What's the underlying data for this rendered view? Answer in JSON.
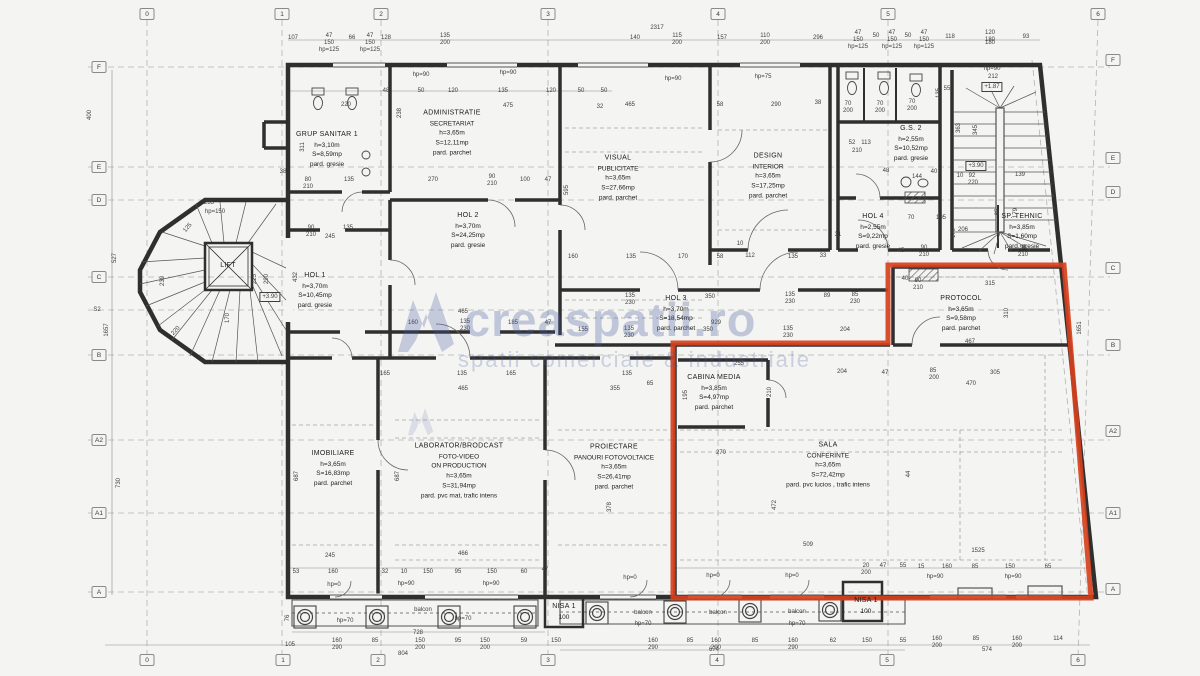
{
  "watermark": {
    "brand": "creaspatii.ro",
    "tagline": "spatii comerciale & industriale"
  },
  "colors": {
    "highlight": "#d5411d",
    "wall": "#2f2f2f",
    "dim_text": "#3f3f3f",
    "grid": "#b3b3b3",
    "watermark": "#485ca2"
  },
  "grid_bubbles": {
    "top": [
      {
        "label": "0",
        "x": 147
      },
      {
        "label": "1",
        "x": 282
      },
      {
        "label": "2",
        "x": 381
      },
      {
        "label": "3",
        "x": 548
      },
      {
        "label": "4",
        "x": 718
      },
      {
        "label": "5",
        "x": 888
      },
      {
        "label": "6",
        "x": 1098
      }
    ],
    "bottom": [
      {
        "label": "0",
        "x": 147
      },
      {
        "label": "1",
        "x": 283
      },
      {
        "label": "2",
        "x": 378
      },
      {
        "label": "3",
        "x": 548
      },
      {
        "label": "4",
        "x": 717
      },
      {
        "label": "5",
        "x": 887
      },
      {
        "label": "6",
        "x": 1078
      }
    ],
    "left": [
      {
        "label": "F",
        "y": 67
      },
      {
        "label": "E",
        "y": 167
      },
      {
        "label": "D",
        "y": 200
      },
      {
        "label": "C",
        "y": 277
      },
      {
        "label": "B",
        "y": 355
      },
      {
        "label": "A2",
        "y": 440
      },
      {
        "label": "A1",
        "y": 513
      },
      {
        "label": "A",
        "y": 592
      }
    ],
    "right": [
      {
        "label": "F",
        "y": 60
      },
      {
        "label": "E",
        "y": 158
      },
      {
        "label": "D",
        "y": 192
      },
      {
        "label": "C",
        "y": 268
      },
      {
        "label": "B",
        "y": 345
      },
      {
        "label": "A2",
        "y": 431
      },
      {
        "label": "A1",
        "y": 513
      },
      {
        "label": "A",
        "y": 589
      }
    ]
  },
  "rooms": [
    {
      "id": "grup-sanitar-1",
      "x": 327,
      "y": 150,
      "lines": [
        "GRUP SANITAR 1",
        "h=3,10m",
        "S=8,59mp",
        "pard. gresie"
      ]
    },
    {
      "id": "administratie-secretariat",
      "x": 452,
      "y": 133,
      "lines": [
        "ADMINISTRATIE",
        "SECRETARIAT",
        "h=3,65m",
        "S=12,11mp",
        "pard. parchet"
      ]
    },
    {
      "id": "hol-2",
      "x": 468,
      "y": 231,
      "lines": [
        "HOL 2",
        "h=3,70m",
        "S=24,25mp",
        "pard. gresie"
      ]
    },
    {
      "id": "hol-1",
      "x": 315,
      "y": 291,
      "lines": [
        "HOL 1",
        "h=3,70m",
        "S=10,45mp",
        "pard. gresie"
      ]
    },
    {
      "id": "visual-publicitate",
      "x": 618,
      "y": 178,
      "lines": [
        "VISUAL",
        "PUBLICITATE",
        "h=3,65m",
        "S=27,66mp",
        "pard. parchet"
      ]
    },
    {
      "id": "design-interior",
      "x": 768,
      "y": 176,
      "lines": [
        "DESIGN",
        "INTERIOR",
        "h=3,65m",
        "S=17,25mp",
        "pard. parchet"
      ]
    },
    {
      "id": "gs-2",
      "x": 911,
      "y": 144,
      "lines": [
        "G.S. 2",
        "h=2,55m",
        "S=10,52mp",
        "pard. gresie"
      ]
    },
    {
      "id": "hol-4",
      "x": 873,
      "y": 232,
      "lines": [
        "HOL 4",
        "h=2,55m",
        "S=9,22mp",
        "pard. gresie"
      ]
    },
    {
      "id": "sp-tehnic",
      "x": 1022,
      "y": 232,
      "lines": [
        "SP. TEHNIC",
        "h=3,85m",
        "S=1,60mp",
        "pard. gresie"
      ]
    },
    {
      "id": "protocol",
      "x": 961,
      "y": 314,
      "lines": [
        "PROTOCOL",
        "h=3,65m",
        "S=9,58mp",
        "pard. parchet"
      ]
    },
    {
      "id": "hol-3",
      "x": 676,
      "y": 314,
      "lines": [
        "HOL 3",
        "h=3,70m",
        "S=18,54mp",
        "pard. parchet"
      ]
    },
    {
      "id": "cabina-media",
      "x": 714,
      "y": 393,
      "lines": [
        "CABINA MEDIA",
        "h=3,85m",
        "S=4,97mp",
        "pard. parchet"
      ]
    },
    {
      "id": "sala-conferinte",
      "x": 828,
      "y": 465,
      "lines": [
        "SALA",
        "CONFERINTE",
        "h=3,65m",
        "S=72,42mp",
        "pard. pvc lucios , trafic intens"
      ]
    },
    {
      "id": "imobiliare",
      "x": 333,
      "y": 469,
      "lines": [
        "IMOBILIARE",
        "h=3,65m",
        "S=16,83mp",
        "pard. parchet"
      ]
    },
    {
      "id": "laborator-brodcast",
      "x": 459,
      "y": 471,
      "lines": [
        "LABORATOR/BRODCAST",
        "FOTO-VIDEO",
        "ON PRODUCTION",
        "h=3,65m",
        "S=31,94mp",
        "pard. pvc mat, trafic intens"
      ]
    },
    {
      "id": "proiectare-fotovoltaice",
      "x": 614,
      "y": 467,
      "lines": [
        "PROIECTARE",
        "PANOURI FOTOVOLTAICE",
        "h=3,65m",
        "S=26,41mp",
        "pard. parchet"
      ]
    },
    {
      "id": "lift",
      "x": 228,
      "y": 266,
      "lines": [
        "LIFT"
      ]
    },
    {
      "id": "nisa-1-left",
      "x": 564,
      "y": 612,
      "lines": [
        "NISA 1",
        "100"
      ]
    },
    {
      "id": "nisa-1-right",
      "x": 866,
      "y": 606,
      "lines": [
        "NISA 1",
        "100"
      ]
    }
  ],
  "labels": [
    [
      657,
      28,
      "2317"
    ],
    [
      293,
      38,
      "107"
    ],
    [
      329,
      36,
      "47"
    ],
    [
      329,
      43,
      "150"
    ],
    [
      352,
      38,
      "66"
    ],
    [
      370,
      36,
      "47"
    ],
    [
      370,
      43,
      "150"
    ],
    [
      386,
      38,
      "128"
    ],
    [
      445,
      36,
      "135"
    ],
    [
      445,
      43,
      "200"
    ],
    [
      635,
      38,
      "140"
    ],
    [
      677,
      36,
      "115"
    ],
    [
      677,
      43,
      "200"
    ],
    [
      722,
      38,
      "157"
    ],
    [
      765,
      36,
      "110"
    ],
    [
      765,
      43,
      "200"
    ],
    [
      818,
      38,
      "296"
    ],
    [
      858,
      33,
      "47"
    ],
    [
      858,
      40,
      "150"
    ],
    [
      876,
      36,
      "50"
    ],
    [
      892,
      33,
      "47"
    ],
    [
      892,
      40,
      "150"
    ],
    [
      908,
      36,
      "50"
    ],
    [
      924,
      33,
      "47"
    ],
    [
      924,
      40,
      "150"
    ],
    [
      950,
      37,
      "118"
    ],
    [
      990,
      33,
      "120"
    ],
    [
      990,
      40,
      "180"
    ],
    [
      1026,
      37,
      "93"
    ],
    [
      329,
      50,
      "hp=125"
    ],
    [
      370,
      50,
      "hp=125"
    ],
    [
      858,
      47,
      "hp=125"
    ],
    [
      892,
      47,
      "hp=125"
    ],
    [
      924,
      47,
      "hp=125"
    ],
    [
      421,
      75,
      "hp=90"
    ],
    [
      508,
      73,
      "hp=90"
    ],
    [
      673,
      79,
      "hp=90"
    ],
    [
      763,
      77,
      "hp=75"
    ],
    [
      992,
      69,
      "hp=90"
    ],
    [
      993,
      77,
      "212"
    ],
    [
      992,
      87,
      "+1.87",
      0,
      "b"
    ],
    [
      386,
      91,
      "48"
    ],
    [
      421,
      91,
      "50"
    ],
    [
      453,
      91,
      "120"
    ],
    [
      503,
      91,
      "135"
    ],
    [
      551,
      91,
      "120"
    ],
    [
      581,
      91,
      "50"
    ],
    [
      604,
      91,
      "50"
    ],
    [
      508,
      106,
      "475"
    ],
    [
      600,
      107,
      "32"
    ],
    [
      400,
      113,
      "238",
      -90
    ],
    [
      630,
      105,
      "465"
    ],
    [
      720,
      105,
      "58"
    ],
    [
      776,
      105,
      "290"
    ],
    [
      818,
      103,
      "38"
    ],
    [
      346,
      105,
      "220"
    ],
    [
      303,
      147,
      "311",
      -90
    ],
    [
      283,
      172,
      "38"
    ],
    [
      308,
      180,
      "80"
    ],
    [
      308,
      187,
      "210"
    ],
    [
      349,
      180,
      "135"
    ],
    [
      848,
      104,
      "70"
    ],
    [
      848,
      111,
      "200"
    ],
    [
      880,
      104,
      "70"
    ],
    [
      880,
      111,
      "200"
    ],
    [
      912,
      102,
      "70"
    ],
    [
      912,
      109,
      "200"
    ],
    [
      939,
      93,
      "135",
      -90
    ],
    [
      947,
      89,
      "55"
    ],
    [
      433,
      180,
      "270"
    ],
    [
      492,
      177,
      "90"
    ],
    [
      492,
      184,
      "210"
    ],
    [
      525,
      180,
      "100"
    ],
    [
      548,
      180,
      "47"
    ],
    [
      852,
      143,
      "52"
    ],
    [
      866,
      143,
      "113"
    ],
    [
      857,
      151,
      "210"
    ],
    [
      886,
      171,
      "48"
    ],
    [
      934,
      172,
      "40"
    ],
    [
      917,
      177,
      "144"
    ],
    [
      960,
      176,
      "10"
    ],
    [
      972,
      176,
      "92"
    ],
    [
      973,
      183,
      "220"
    ],
    [
      959,
      128,
      "363",
      -90
    ],
    [
      976,
      130,
      "345",
      -90
    ],
    [
      976,
      166,
      "+3.90",
      0,
      "b"
    ],
    [
      1020,
      175,
      "139"
    ],
    [
      998,
      212,
      "85",
      -90
    ],
    [
      1016,
      213,
      "179",
      -90
    ],
    [
      1023,
      248,
      "90"
    ],
    [
      1023,
      255,
      "210"
    ],
    [
      963,
      230,
      "206"
    ],
    [
      954,
      233,
      "170",
      -90
    ],
    [
      941,
      218,
      "105"
    ],
    [
      911,
      218,
      "70"
    ],
    [
      901,
      251,
      "45"
    ],
    [
      924,
      248,
      "90"
    ],
    [
      924,
      255,
      "210"
    ],
    [
      990,
      43,
      "180"
    ],
    [
      311,
      228,
      "90"
    ],
    [
      311,
      235,
      "210"
    ],
    [
      348,
      228,
      "135"
    ],
    [
      330,
      237,
      "245"
    ],
    [
      463,
      312,
      "465"
    ],
    [
      413,
      323,
      "160"
    ],
    [
      465,
      322,
      "135"
    ],
    [
      465,
      329,
      "230"
    ],
    [
      513,
      323,
      "185"
    ],
    [
      548,
      323,
      "47"
    ],
    [
      583,
      330,
      "155"
    ],
    [
      385,
      374,
      "165"
    ],
    [
      462,
      374,
      "135"
    ],
    [
      511,
      374,
      "165"
    ],
    [
      627,
      374,
      "135"
    ],
    [
      650,
      384,
      "65"
    ],
    [
      463,
      389,
      "465"
    ],
    [
      615,
      389,
      "355"
    ],
    [
      209,
      203,
      "235"
    ],
    [
      215,
      212,
      "hp=150"
    ],
    [
      188,
      228,
      "125",
      -50
    ],
    [
      163,
      281,
      "239",
      -90
    ],
    [
      255,
      279,
      "225",
      -90
    ],
    [
      267,
      279,
      "290",
      -90
    ],
    [
      296,
      277,
      "432",
      -90
    ],
    [
      176,
      331,
      "220",
      -48
    ],
    [
      270,
      297,
      "+3.90",
      0,
      "b"
    ],
    [
      228,
      318,
      "170",
      -90
    ],
    [
      630,
      296,
      "135"
    ],
    [
      630,
      303,
      "230"
    ],
    [
      710,
      297,
      "350"
    ],
    [
      790,
      295,
      "135"
    ],
    [
      790,
      302,
      "230"
    ],
    [
      827,
      296,
      "89"
    ],
    [
      855,
      295,
      "85"
    ],
    [
      855,
      302,
      "230"
    ],
    [
      716,
      323,
      "929"
    ],
    [
      629,
      329,
      "135"
    ],
    [
      629,
      336,
      "230"
    ],
    [
      708,
      330,
      "350"
    ],
    [
      788,
      329,
      "135"
    ],
    [
      788,
      336,
      "230"
    ],
    [
      845,
      330,
      "204"
    ],
    [
      905,
      279,
      "40"
    ],
    [
      918,
      281,
      "90"
    ],
    [
      918,
      288,
      "210"
    ],
    [
      573,
      257,
      "160"
    ],
    [
      631,
      257,
      "135"
    ],
    [
      683,
      257,
      "170"
    ],
    [
      720,
      257,
      "58"
    ],
    [
      750,
      256,
      "112"
    ],
    [
      793,
      257,
      "135"
    ],
    [
      823,
      256,
      "33"
    ],
    [
      838,
      235,
      "31"
    ],
    [
      740,
      244,
      "10"
    ],
    [
      990,
      284,
      "315"
    ],
    [
      1007,
      313,
      "310",
      -90
    ],
    [
      970,
      342,
      "467"
    ],
    [
      933,
      371,
      "85"
    ],
    [
      934,
      378,
      "200"
    ],
    [
      995,
      373,
      "305"
    ],
    [
      971,
      384,
      "470"
    ],
    [
      739,
      364,
      "255"
    ],
    [
      842,
      372,
      "204"
    ],
    [
      885,
      373,
      "47"
    ],
    [
      721,
      453,
      "270"
    ],
    [
      775,
      505,
      "472",
      -90
    ],
    [
      808,
      545,
      "509"
    ],
    [
      686,
      395,
      "195",
      -90
    ],
    [
      770,
      392,
      "210",
      -90
    ],
    [
      909,
      474,
      "44",
      -90
    ],
    [
      1080,
      328,
      "1651",
      -90
    ],
    [
      297,
      476,
      "687",
      -90
    ],
    [
      398,
      476,
      "687",
      -90
    ],
    [
      567,
      190,
      "595",
      -90
    ],
    [
      610,
      507,
      "378",
      -90
    ],
    [
      330,
      556,
      "245"
    ],
    [
      463,
      554,
      "466"
    ],
    [
      296,
      572,
      "53"
    ],
    [
      333,
      572,
      "160"
    ],
    [
      385,
      572,
      "32"
    ],
    [
      404,
      572,
      "10"
    ],
    [
      428,
      572,
      "150"
    ],
    [
      458,
      572,
      "95"
    ],
    [
      492,
      572,
      "150"
    ],
    [
      524,
      572,
      "60"
    ],
    [
      545,
      570,
      "47"
    ],
    [
      866,
      566,
      "20"
    ],
    [
      866,
      573,
      "200"
    ],
    [
      883,
      566,
      "47"
    ],
    [
      903,
      566,
      "55"
    ],
    [
      921,
      567,
      "15"
    ],
    [
      947,
      567,
      "160"
    ],
    [
      975,
      567,
      "85"
    ],
    [
      1010,
      567,
      "150"
    ],
    [
      1048,
      567,
      "65"
    ],
    [
      978,
      551,
      "1525"
    ],
    [
      334,
      585,
      "hp=0"
    ],
    [
      406,
      584,
      "hp=90"
    ],
    [
      491,
      584,
      "hp=90"
    ],
    [
      630,
      578,
      "hp=0"
    ],
    [
      713,
      576,
      "hp=0"
    ],
    [
      792,
      576,
      "hp=0"
    ],
    [
      935,
      577,
      "hp=90"
    ],
    [
      1013,
      577,
      "hp=90"
    ],
    [
      423,
      610,
      "balcon"
    ],
    [
      643,
      613,
      "balcon"
    ],
    [
      718,
      613,
      "balcon"
    ],
    [
      797,
      612,
      "balcon"
    ],
    [
      345,
      621,
      "hp=70"
    ],
    [
      463,
      619,
      "hp=70"
    ],
    [
      643,
      624,
      "hp=70"
    ],
    [
      797,
      624,
      "hp=70"
    ],
    [
      290,
      645,
      "105"
    ],
    [
      337,
      641,
      "160"
    ],
    [
      337,
      648,
      "290"
    ],
    [
      375,
      641,
      "85"
    ],
    [
      420,
      641,
      "150"
    ],
    [
      420,
      648,
      "200"
    ],
    [
      458,
      641,
      "95"
    ],
    [
      485,
      641,
      "150"
    ],
    [
      485,
      648,
      "200"
    ],
    [
      524,
      641,
      "59"
    ],
    [
      556,
      641,
      "150"
    ],
    [
      653,
      641,
      "160"
    ],
    [
      653,
      648,
      "290"
    ],
    [
      690,
      641,
      "85"
    ],
    [
      716,
      641,
      "160"
    ],
    [
      716,
      648,
      "290"
    ],
    [
      755,
      641,
      "85"
    ],
    [
      793,
      641,
      "160"
    ],
    [
      793,
      648,
      "290"
    ],
    [
      833,
      641,
      "62"
    ],
    [
      867,
      641,
      "150"
    ],
    [
      903,
      641,
      "55"
    ],
    [
      937,
      639,
      "160"
    ],
    [
      937,
      646,
      "200"
    ],
    [
      976,
      639,
      "85"
    ],
    [
      1017,
      639,
      "160"
    ],
    [
      1017,
      646,
      "200"
    ],
    [
      1058,
      639,
      "114"
    ],
    [
      418,
      633,
      "728"
    ],
    [
      403,
      654,
      "804"
    ],
    [
      714,
      650,
      "674"
    ],
    [
      987,
      650,
      "574"
    ],
    [
      288,
      618,
      "76",
      -90
    ],
    [
      90,
      115,
      "400",
      -90
    ],
    [
      115,
      258,
      "527",
      -90
    ],
    [
      107,
      330,
      "1657",
      -90
    ],
    [
      119,
      483,
      "730",
      -90
    ],
    [
      97,
      310,
      "S2"
    ]
  ]
}
